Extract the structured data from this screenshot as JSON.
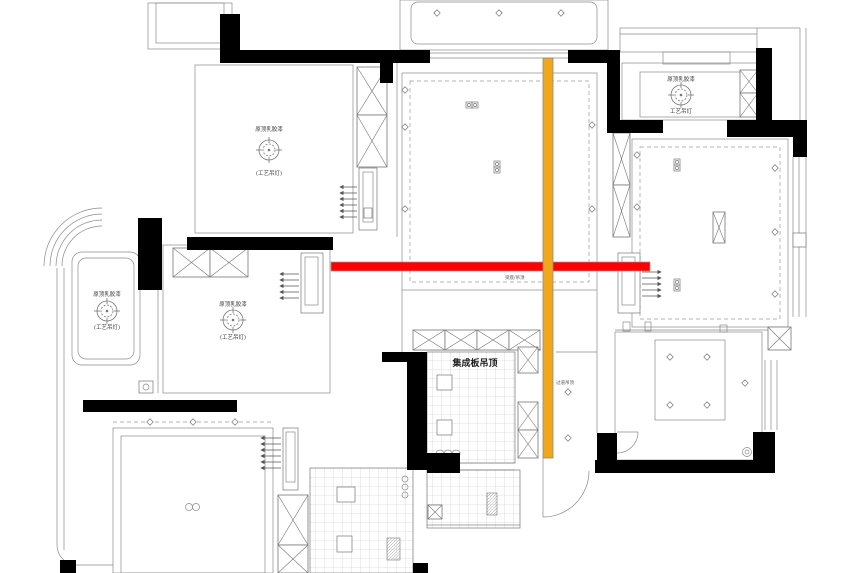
{
  "drawing": {
    "type": "ceiling-plan",
    "colors": {
      "beam_highlight": "#ff0000",
      "shaft_highlight": "#f2a71b",
      "wall": "#000000",
      "line": "#8a8a8a"
    },
    "rooms": [
      {
        "id": "bedroom-top-left",
        "ceiling_label": "原顶乳胶漆",
        "lamp_label": "(工艺吊灯)"
      },
      {
        "id": "balcony-left",
        "ceiling_label": "原顶乳胶漆",
        "lamp_label": "(工艺吊灯)"
      },
      {
        "id": "bedroom-middle-left",
        "ceiling_label": "原顶乳胶漆",
        "lamp_label": "(工艺吊灯)"
      },
      {
        "id": "bathroom-top-right",
        "ceiling_label": "原顶乳胶漆",
        "lamp_label": "工艺吊灯"
      }
    ],
    "kitchen": {
      "ceiling_label": "集成板吊顶"
    },
    "annotations": {
      "beam_note": "梁底/吊顶",
      "corridor_note": "过道吊顶"
    }
  }
}
